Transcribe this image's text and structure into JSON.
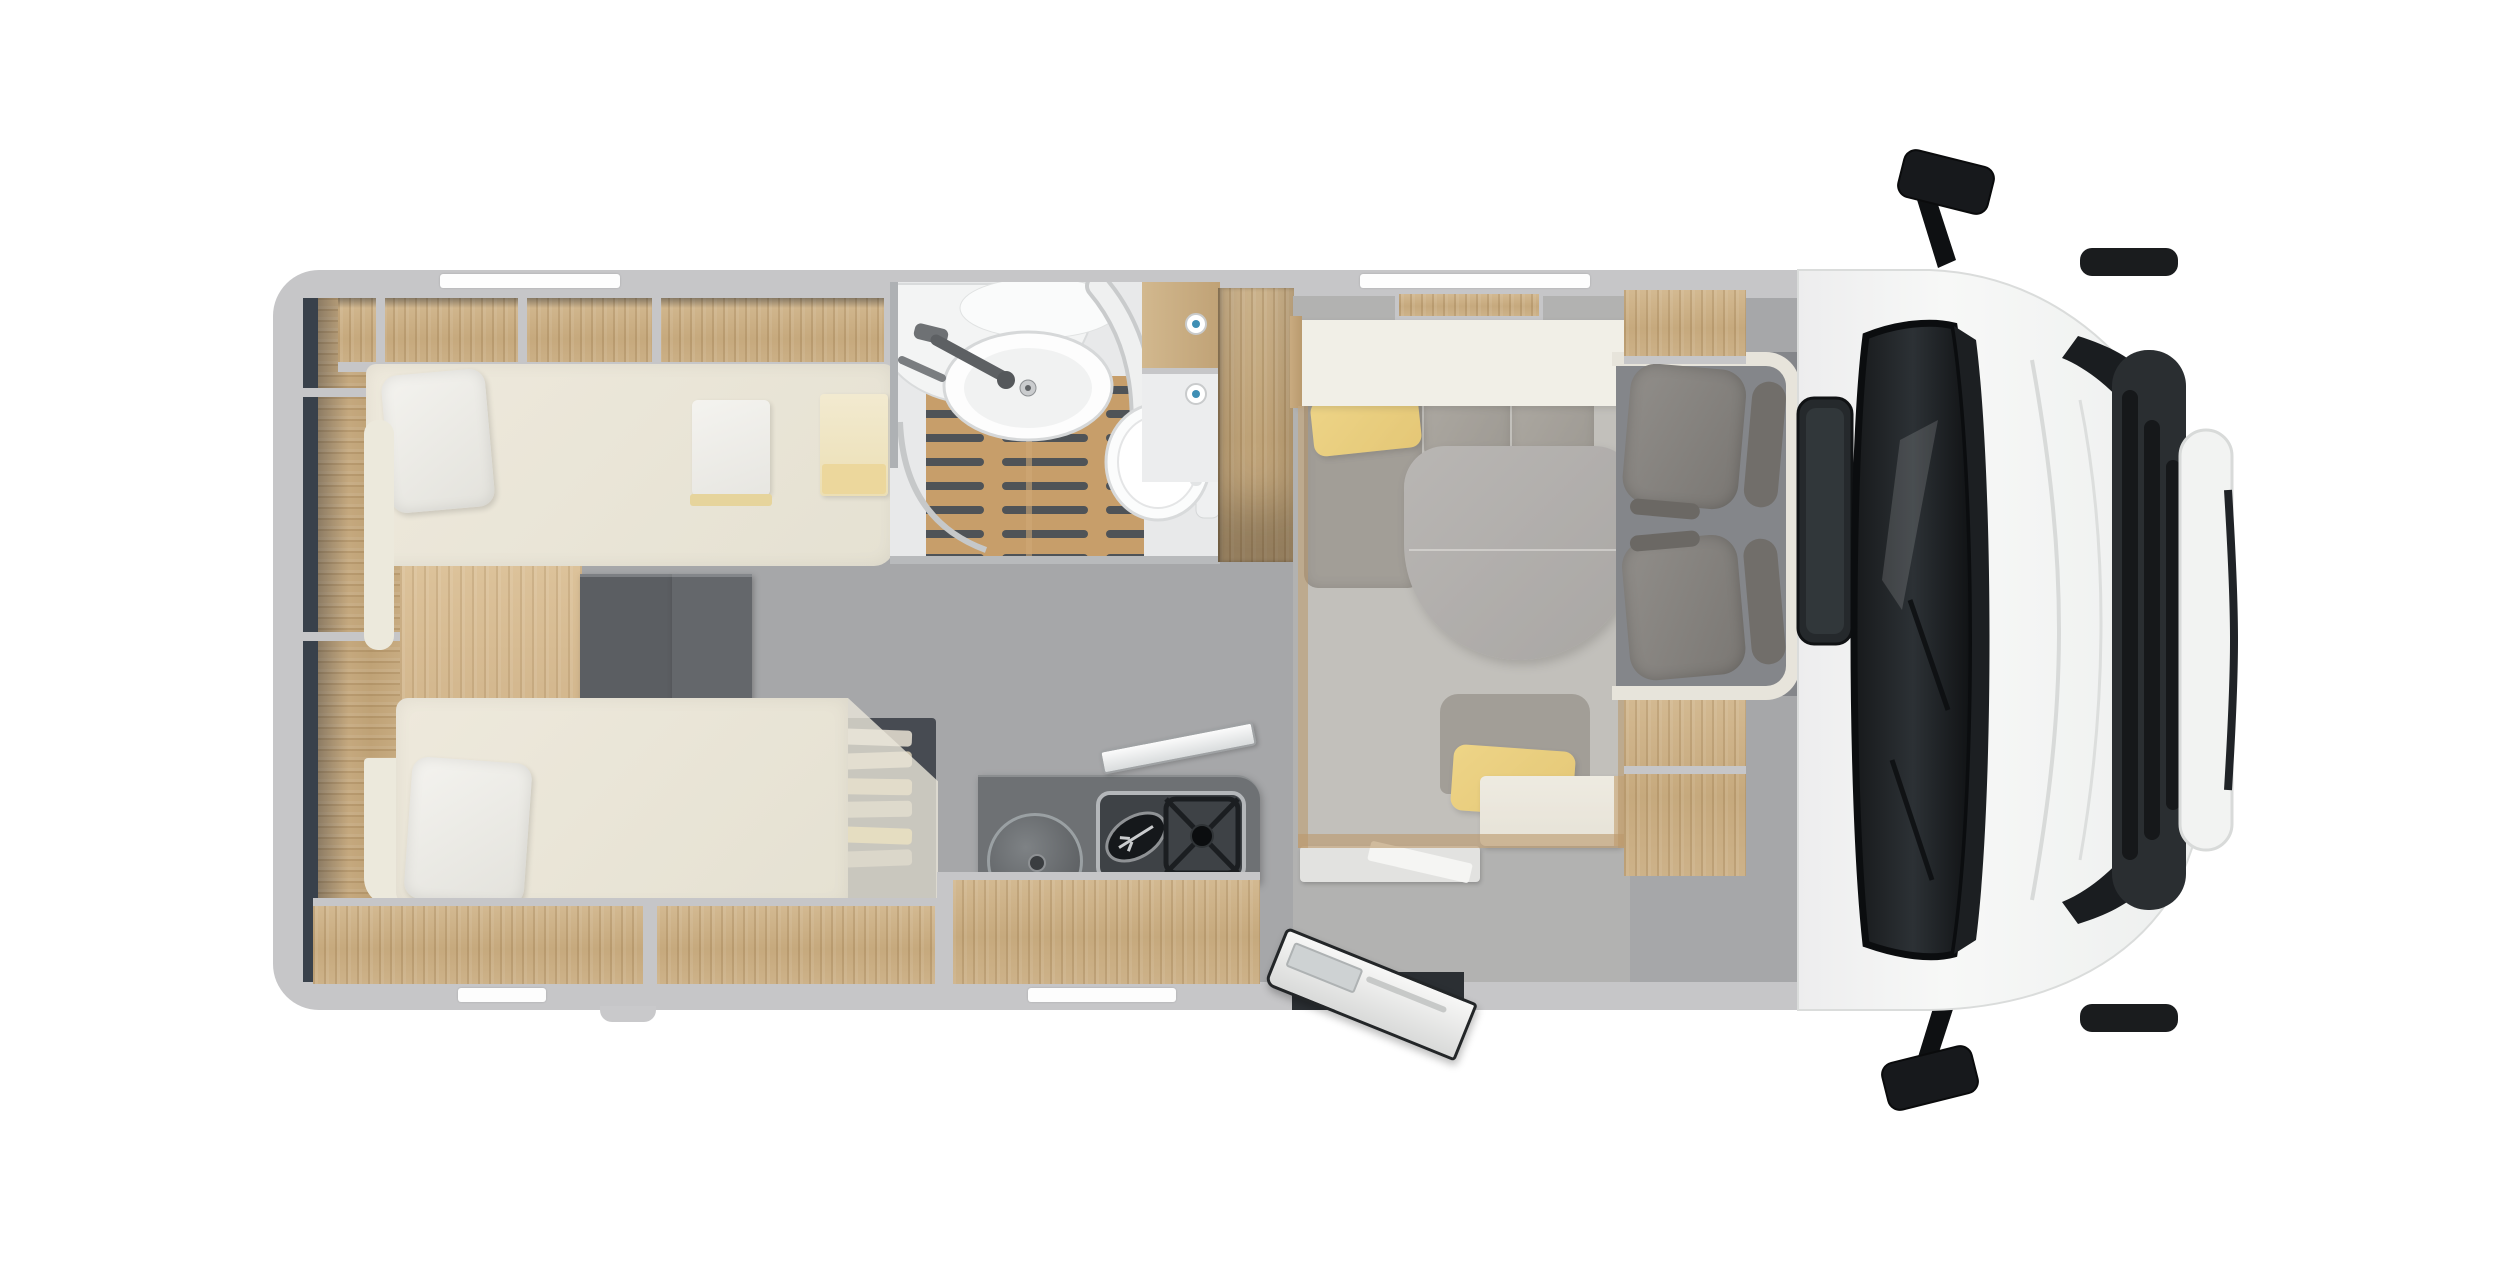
{
  "scene": {
    "kind": "motorhome-floorplan-top-view-render",
    "width_px": 2500,
    "height_px": 1280,
    "background": "#ffffff",
    "orientation": "vehicle front at right, rear at left"
  },
  "theme": {
    "page": "#ffffff",
    "wall": "#c6c6c8",
    "interior_shadow": "#39414b",
    "wood": "#c9ad83",
    "mattress_cream": "#eae6d9",
    "floor_corridor": "#a6a7a9",
    "floor_dinette": "#b2b2b1",
    "floor_cab": "#84868a",
    "teak": "#c79e6a",
    "seat_grey": "#8b8884",
    "seat_dark": "#84817d",
    "table_grey": "#9b9a9c",
    "accent_yellow": "#ecc95f",
    "counter_dark": "#6e7174",
    "hob_dark": "#3e4246",
    "fixture_white": "#fbfbfc",
    "cab_white": "#f2f3f2",
    "glass_dark": "#1d2124",
    "knob_blue": "#3f8fb5",
    "step_dark": "#5b5e62"
  },
  "zones": {
    "rear_shelves": {
      "label": "Rear wall storage shelves"
    },
    "overhead_lockers": {
      "label": "Overhead lockers above rear bed"
    },
    "rear_bedroom": {
      "label": "Rear bedroom with twin single beds"
    },
    "bed_top": {
      "label": "Single bed (offside) with pillow, folded clothes and towels"
    },
    "bed_bottom": {
      "label": "Single bed (door side) with pillow over wardrobe"
    },
    "steps": {
      "label": "Steps between the twin beds"
    },
    "bathroom": {
      "label": "Bathroom with corner washbasin, shower teak floor and toilet"
    },
    "wardrobe": {
      "label": "Tall wardrobe between bathroom and dinette"
    },
    "kitchen": {
      "label": "Kitchen block with round sink and two-burner hob"
    },
    "dinette": {
      "label": "Half-dinette with oval table and yellow cushions"
    },
    "drop_down_bed": {
      "label": "Drop-down bed above dinette (shown translucent)"
    },
    "entry_door": {
      "label": "Entry door shown open"
    },
    "cab_seating": {
      "label": "Cab with two swivel captain seats"
    },
    "vehicle_front": {
      "label": "Cab exterior: windscreen, mirrors, bonnet and grille"
    }
  },
  "features": {
    "beds_rear": 2,
    "bed_items": [
      "white pillow",
      "folded white clothes",
      "yellow towels"
    ],
    "bathroom_fixtures": [
      "corner washbasin",
      "grey faucet",
      "teak shower grate",
      "toilet",
      "mirror cabinet with blue knobs"
    ],
    "kitchen_fixtures": [
      "round sink with lid",
      "two-burner gas hob",
      "leaning glass lid"
    ],
    "dinette_fixtures": [
      "L-bench",
      "oval split table",
      "single seat",
      "2 yellow cushions"
    ],
    "cab_fixtures": [
      "2 swivel seats",
      "2 exterior mirrors",
      "roof skylight",
      "windscreen with wipers"
    ],
    "door_state": "open"
  }
}
